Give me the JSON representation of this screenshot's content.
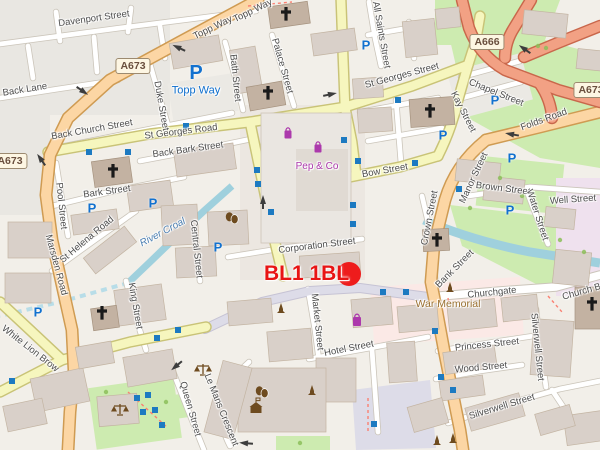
{
  "postcode": {
    "label": "BL1 1BL",
    "marker_color": "#ee1c1c"
  },
  "badges": [
    "A673",
    "A673",
    "A666",
    "A673"
  ],
  "streets": [
    "Davenport Street",
    "Topp Way",
    "Topp Way",
    "Back Lane",
    "Back Church Street",
    "St Georges Road",
    "Back Bark Street",
    "Duke Street",
    "Bath Street",
    "Palace Street",
    "All Saints Street",
    "St Georges Street",
    "Chapel Street",
    "Kay Street",
    "Folds Road",
    "Bow Street",
    "Manor Street",
    "Brown Street",
    "Well Street",
    "Water Street",
    "Crown Street",
    "Bank Street",
    "Corporation Street",
    "Central Street",
    "Bark Street",
    "Pool Street",
    "St Helena Road",
    "Marsden Road",
    "King Street",
    "White Lion Brow",
    "Queen Street",
    "Le Mans Crescent",
    "Market Street",
    "Hotel Street",
    "Churchgate",
    "Church Bank",
    "Princess Street",
    "Wood Street",
    "Silverwell Street",
    "Silverwell Street"
  ],
  "pois": {
    "pep_co": "Pep & Co",
    "war_memorial": "War Memorial",
    "parking_name": "Topp Way",
    "river": "River Croal"
  },
  "icons": {
    "parking": "P"
  },
  "colors": {
    "marker_red": "#ee1c1c",
    "parking_blue": "#1271cf",
    "shop_purple": "#ac39ac",
    "water_label_blue": "#4d80b3",
    "memorial_brown": "#9a7030",
    "primary_road": "#fcd6a4",
    "trunk_road": "#f2a184",
    "secondary_road": "#f6f6be"
  }
}
